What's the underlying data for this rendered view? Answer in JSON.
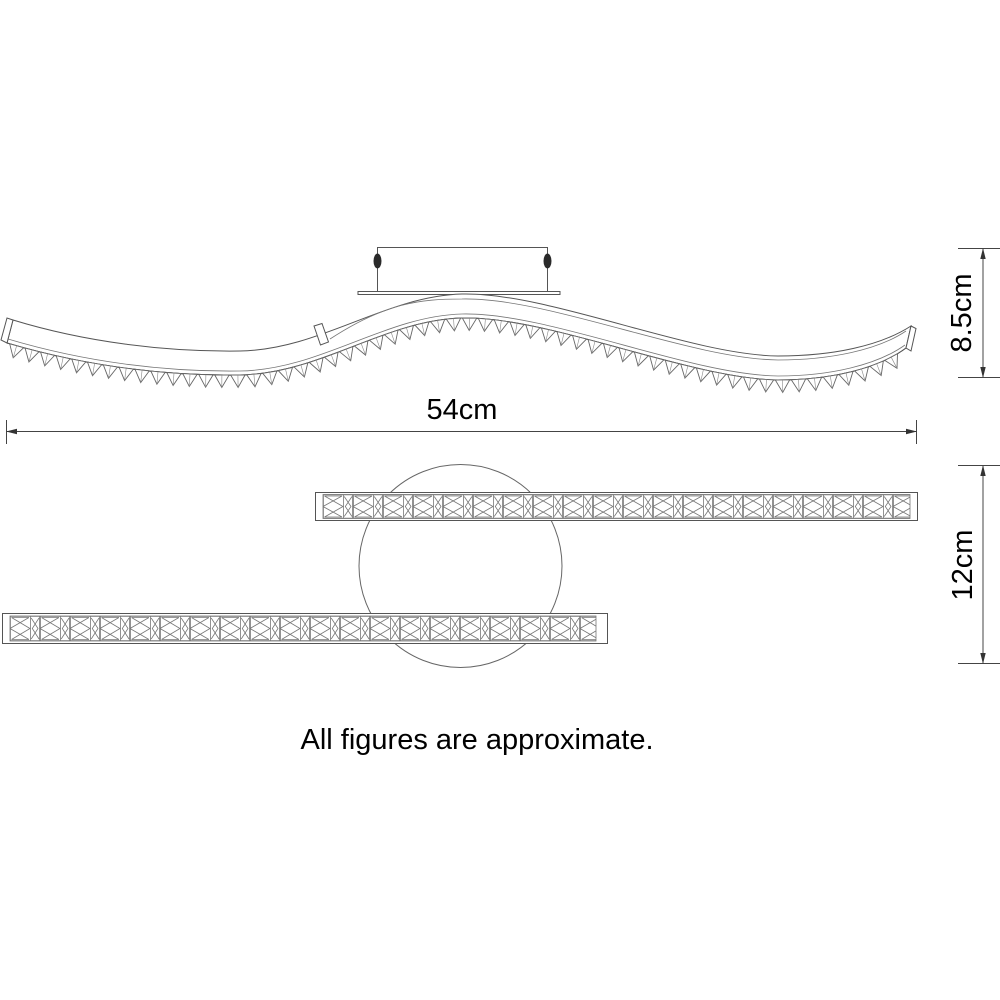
{
  "diagram": {
    "type": "product-dimension-drawing",
    "note": "All figures are approximate.",
    "dimensions": [
      {
        "id": "overall-width",
        "label": "54cm",
        "orientation": "horizontal"
      },
      {
        "id": "fixture-height",
        "label": "8.5cm",
        "orientation": "vertical"
      },
      {
        "id": "bar-spread",
        "label": "12cm",
        "orientation": "vertical"
      }
    ],
    "colors": {
      "line": "#555555",
      "text": "#000000",
      "background": "#ffffff"
    }
  }
}
